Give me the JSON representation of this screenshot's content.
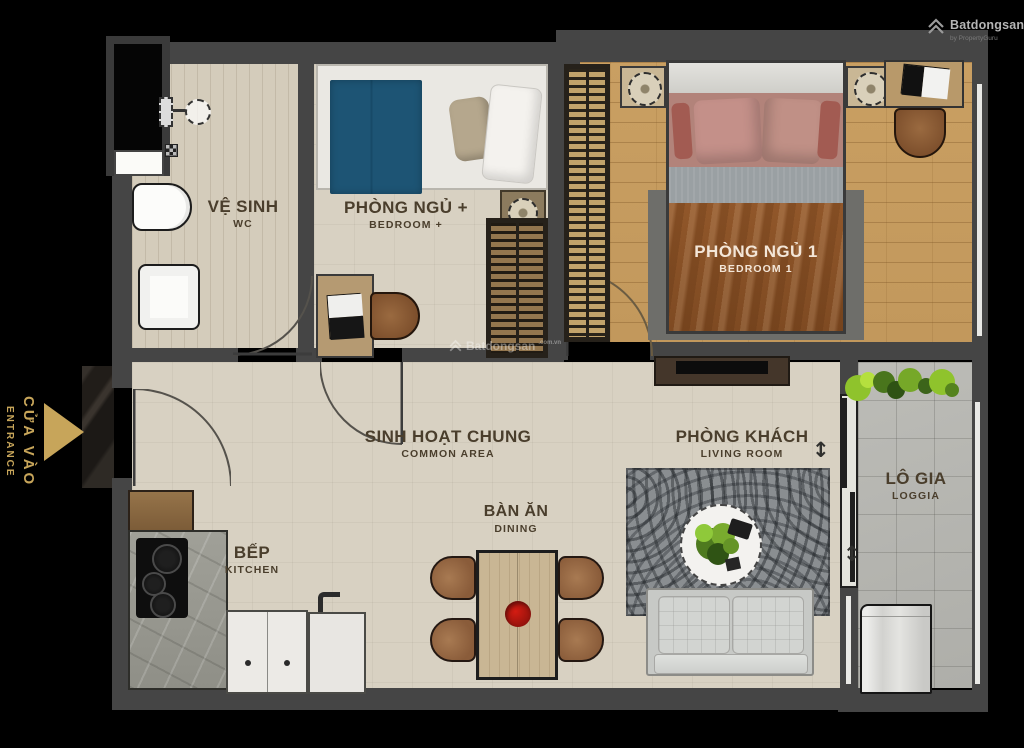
{
  "meta": {
    "site_brand": "Batdongsan",
    "site_tld": ".com.vn",
    "site_byline": "by PropertyGuru"
  },
  "watermark": {
    "brand": "Batdongsan",
    "tld": ".com.vn"
  },
  "entrance": {
    "vi": "CỬA VÀO",
    "en": "ENTRANCE"
  },
  "rooms": {
    "wc": {
      "vi": "VỆ SINH",
      "en": "WC"
    },
    "bedroom_plus": {
      "vi": "PHÒNG NGỦ +",
      "en": "BEDROOM +"
    },
    "bedroom_1": {
      "vi": "PHÒNG NGỦ 1",
      "en": "BEDROOM 1"
    },
    "common_area": {
      "vi": "SINH HOẠT CHUNG",
      "en": "COMMON AREA"
    },
    "living_room": {
      "vi": "PHÒNG KHÁCH",
      "en": "LIVING ROOM"
    },
    "dining": {
      "vi": "BÀN ĂN",
      "en": "DINING"
    },
    "kitchen": {
      "vi": "BẾP",
      "en": "KITCHEN"
    },
    "loggia": {
      "vi": "LÔ GIA",
      "en": "LOGGIA"
    }
  },
  "symbols": {
    "updown_arrow": "↕"
  },
  "colors": {
    "background": "#000000",
    "wall": "#454545",
    "floor_beige": "#d8d1c2",
    "floor_wood": "#c89f63",
    "floor_loggia": "#b6b6b1",
    "accent_gold": "#c7a55a",
    "label_brown": "#4a3e2c",
    "blanket_blue": "#1d5474",
    "blanket_brown": "#8a5127",
    "pillow_pink": "#c08b80"
  }
}
